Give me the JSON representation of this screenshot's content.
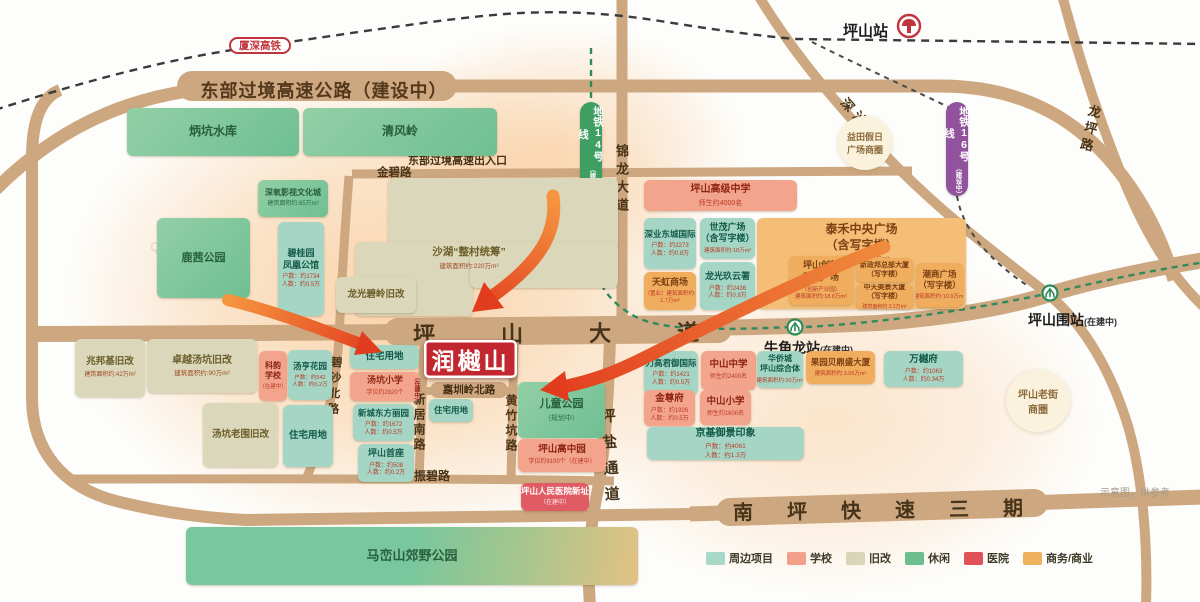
{
  "note": "示意图，供参考",
  "watermark": "Q房网",
  "project_box": {
    "name": "润樾山"
  },
  "roads": {
    "east_highway": "东部过境高速公路（建设中）",
    "highway_exit": "东部过境高速出入口",
    "jinbi": "金碧路",
    "pingshan_avenue": "坪山大道",
    "jinlong_avenue": "锦龙大道",
    "shenshan": "深汕路",
    "longping": "龙坪路",
    "bisha_north": "碧沙北路",
    "xinju_south": "新居南路",
    "huangzhukeng": "黄竹坑路",
    "jiazhenling_north": "嘉圳岭北路",
    "zhenbi": "振碧路",
    "pingyan": "坪盐通道",
    "nanping": "南坪快速三期"
  },
  "rail": {
    "xiashen": "厦深高铁",
    "line14": {
      "label": "地铁14号线",
      "status": "（建设中）"
    },
    "line16": {
      "label": "地铁16号线",
      "status": "（建设中）"
    }
  },
  "stations": {
    "pingshan": {
      "label": "坪山站"
    },
    "niujiaolong": {
      "label": "牛角龙站",
      "status": "(在建中)"
    },
    "pingshanwei": {
      "label": "坪山围站",
      "status": "(在建中)"
    }
  },
  "circles": {
    "yitian": [
      "益田假日",
      "广场商圈"
    ],
    "laojie": [
      "坪山老街",
      "商圈"
    ]
  },
  "blocks": [
    {
      "id": "bingkeng",
      "type": "leisure",
      "title": [
        "炳坑水库"
      ]
    },
    {
      "id": "qingfengling",
      "type": "leisure",
      "title": [
        "清风岭"
      ]
    },
    {
      "id": "yingshi",
      "type": "leisure",
      "title": [
        "深氧影视文化城"
      ],
      "subs": [
        "建筑面积约:65万m²"
      ]
    },
    {
      "id": "luxi_park",
      "type": "leisure",
      "title": [
        "鹿茜公园"
      ]
    },
    {
      "id": "biguiyuan",
      "type": "project",
      "title": [
        "碧桂园",
        "凤凰公馆"
      ],
      "subs": [
        "户数：约1734",
        "人数：约0.5万"
      ]
    },
    {
      "id": "shahu",
      "type": "renewal",
      "title": [
        "沙湖“整村统筹”"
      ],
      "subs": [
        "建筑面积约:220万m²"
      ]
    },
    {
      "id": "longguang_biling",
      "type": "renewal",
      "title": [
        "龙光碧岭旧改"
      ]
    },
    {
      "id": "zhaobangji",
      "type": "renewal",
      "title": [
        "兆邦基旧改"
      ],
      "subs": [
        "建筑面积约:42万m²"
      ]
    },
    {
      "id": "zhuoyue",
      "type": "renewal",
      "title": [
        "卓越汤坑旧改"
      ],
      "subs": [
        "建筑面积约:90万m²"
      ]
    },
    {
      "id": "keyun",
      "type": "school",
      "title": [
        "科韵",
        "学校"
      ],
      "subs": [
        "（在建中）"
      ]
    },
    {
      "id": "tangheng",
      "type": "project",
      "title": [
        "汤亨花园"
      ],
      "subs": [
        "户数：约542",
        "人数：约0.2万"
      ]
    },
    {
      "id": "laowei",
      "type": "renewal",
      "title": [
        "汤坑老围旧改"
      ]
    },
    {
      "id": "zhuzhai_w",
      "type": "land",
      "title": [
        "住宅用地"
      ]
    },
    {
      "id": "zhuzhai_n",
      "type": "land",
      "title": [
        "住宅用地"
      ]
    },
    {
      "id": "tangkeng_xiaoxue",
      "type": "school",
      "title": [
        "汤坑小学"
      ],
      "subs": [
        "学位约2820个"
      ],
      "side": "（在建中）"
    },
    {
      "id": "xincheng",
      "type": "project",
      "title": [
        "新城东方丽园"
      ],
      "subs": [
        "户数：约1672",
        "人数：约0.5万"
      ]
    },
    {
      "id": "shouzuo",
      "type": "project",
      "title": [
        "坪山首座"
      ],
      "subs": [
        "户数：约508",
        "人数：约0.2万"
      ]
    },
    {
      "id": "zhuzhai_c",
      "type": "land",
      "title": [
        "住宅用地"
      ]
    },
    {
      "id": "ertong",
      "type": "leisure",
      "title": [
        "儿童公园"
      ],
      "subs": [
        "（规划中）"
      ]
    },
    {
      "id": "gaozhongyuan",
      "type": "school",
      "title": [
        "坪山高中园"
      ],
      "subs": [
        "学位约9100个（在建中）"
      ]
    },
    {
      "id": "renmin_hospital",
      "type": "hospital",
      "title": [
        "坪山人民医院新址"
      ],
      "subs": [
        "（在建中）"
      ]
    },
    {
      "id": "maluan",
      "type": "leisure",
      "title": [
        "马峦山郊野公园"
      ]
    },
    {
      "id": "gaoji_zhongxue",
      "type": "school",
      "title": [
        "坪山高级中学"
      ],
      "subs": [
        "师生约4000名"
      ]
    },
    {
      "id": "shenye",
      "type": "project",
      "title": [
        "深业东城国际"
      ],
      "subs": [
        "户数：约2273",
        "人数：约0.8万"
      ]
    },
    {
      "id": "shimao",
      "type": "project",
      "title": [
        "世茂广场",
        "（含写字楼）"
      ],
      "subs": [
        "建筑面积约:18万m²"
      ]
    },
    {
      "id": "tianhong",
      "type": "business",
      "title": [
        "天虹商场"
      ],
      "subs": [
        "（置业）建筑面积约:",
        "1.7万m²"
      ]
    },
    {
      "id": "jiuyunzhu",
      "type": "project",
      "title": [
        "龙光玖云著"
      ],
      "subs": [
        "户数：约2436",
        "人数：约0.9万"
      ]
    },
    {
      "id": "taihe",
      "type": "business-area",
      "title": [
        "泰禾中央广场",
        "（含写字楼）"
      ],
      "subs": [
        "建筑面积约:55万m²"
      ]
    },
    {
      "id": "chuangxin",
      "type": "business",
      "title": [
        "坪山创新",
        "科技广场"
      ],
      "subs": [
        "（创新产业园）",
        "建筑面积约:18.8万m²"
      ]
    },
    {
      "id": "xinzhengbang",
      "type": "business",
      "title": [
        "新政邦总部大厦",
        "（写字楼）"
      ]
    },
    {
      "id": "zhongtian",
      "type": "business",
      "title": [
        "中天美景大厦",
        "（写字楼）"
      ],
      "subs": [
        "建筑面积约:3.1万m²"
      ]
    },
    {
      "id": "chaoshang",
      "type": "business",
      "title": [
        "潮商广场",
        "（写字楼）"
      ],
      "subs": [
        "建筑面积约:10.9万m²"
      ]
    },
    {
      "id": "ligao",
      "type": "project",
      "title": [
        "力高君御国际"
      ],
      "subs": [
        "户数：约1421",
        "人数：约0.5万"
      ]
    },
    {
      "id": "zs_zhongxue",
      "type": "school",
      "title": [
        "中山中学"
      ],
      "subs": [
        "师生约2400名"
      ]
    },
    {
      "id": "hqc",
      "type": "project",
      "title": [
        "华侨城",
        "坪山综合体"
      ],
      "subs": [
        "建筑面积约:20万m²"
      ]
    },
    {
      "id": "guoyuan",
      "type": "business",
      "title": [
        "果园贝鼎盛大厦"
      ],
      "subs": [
        "建筑面积约:3.06万m²"
      ]
    },
    {
      "id": "wanyuefu",
      "type": "project",
      "title": [
        "万樾府"
      ],
      "subs": [
        "户数：约1063",
        "人数：约0.34万"
      ]
    },
    {
      "id": "jinzunfu",
      "type": "school",
      "title": [
        "金尊府"
      ],
      "subs": [
        "户数：约1926",
        "人数：约0.5万"
      ]
    },
    {
      "id": "zs_xiaoxue",
      "type": "school",
      "title": [
        "中山小学"
      ],
      "subs": [
        "师生约1600名"
      ]
    },
    {
      "id": "jingji",
      "type": "project",
      "title": [
        "京基御景印象"
      ],
      "subs": [
        "户数：约4061",
        "人数：约1.3万"
      ]
    }
  ],
  "legend": {
    "items": [
      {
        "label": "周边项目",
        "color": "#a8d8c8"
      },
      {
        "label": "学校",
        "color": "#f2a08a"
      },
      {
        "label": "旧改",
        "color": "#d8d5b8"
      },
      {
        "label": "休闲",
        "color": "#6cbe8f"
      },
      {
        "label": "医院",
        "color": "#e05258"
      },
      {
        "label": "商务/商业",
        "color": "#eeb25e"
      }
    ]
  },
  "colors": {
    "road": "#cda77f",
    "project_red": "#c2262e",
    "arrow": "#e23c1f",
    "metro14_green": "#3f9e62",
    "metro16_purple": "#91539e"
  }
}
